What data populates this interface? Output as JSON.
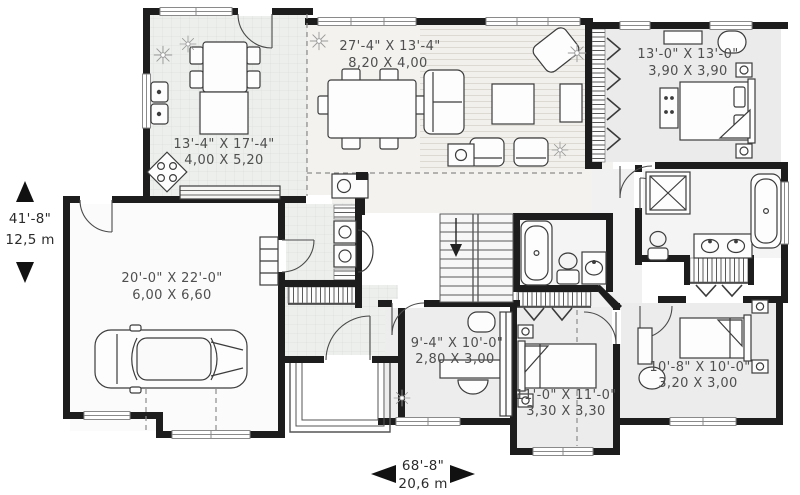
{
  "plan": {
    "rooms": {
      "great_room": {
        "imperial": "27'-4\" X 13'-4\"",
        "metric": "8,20 X 4,00"
      },
      "kitchen": {
        "imperial": "13'-4\" X 17'-4\"",
        "metric": "4,00 X 5,20"
      },
      "master_bedroom": {
        "imperial": "13'-0\" X 13'-0\"",
        "metric": "3,90 X 3,90"
      },
      "garage": {
        "imperial": "20'-0\" X 22'-0\"",
        "metric": "6,00 X 6,60"
      },
      "den": {
        "imperial": "9'-4\" X 10'-0\"",
        "metric": "2,80 X 3,00"
      },
      "bedroom_2": {
        "imperial": "11'-0\" X 11'-0\"",
        "metric": "3,30 X 3,30"
      },
      "bedroom_3": {
        "imperial": "10'-8\" X 10'-0\"",
        "metric": "3,20 X 3,00"
      }
    },
    "overall_dimensions": {
      "height": {
        "imperial": "41'-8\"",
        "metric": "12,5 m"
      },
      "width": {
        "imperial": "68'-8\"",
        "metric": "20,6 m"
      }
    },
    "colors": {
      "wall": "#1d1d1d",
      "label_text": "#4f4f4f",
      "dimension_text": "#2b2b2b"
    }
  }
}
